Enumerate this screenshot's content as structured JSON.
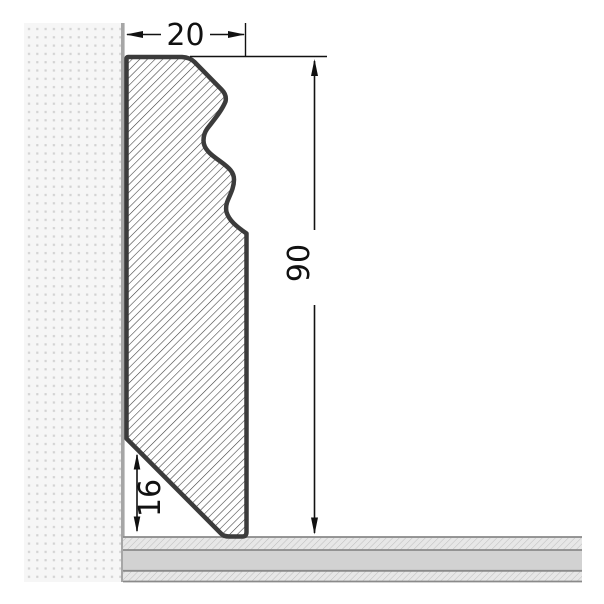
{
  "drawing": {
    "dims": {
      "width": "20",
      "height": "90",
      "bevel_height": "16"
    },
    "colors": {
      "profile_outline": "#3b3b3b",
      "profile_hatch_line": "#3f3f3f",
      "dimension": "#111111",
      "wall_background": "#f6f6f6",
      "wall_dot": "#d2d2d2",
      "wall_edge": "#a6a6a6",
      "floor_base": "#d2d2d2",
      "floor_hatch_bg": "#e7e7e7",
      "floor_hatch_line": "#bdbdbd",
      "floor_border": "#8a8a8a"
    }
  }
}
